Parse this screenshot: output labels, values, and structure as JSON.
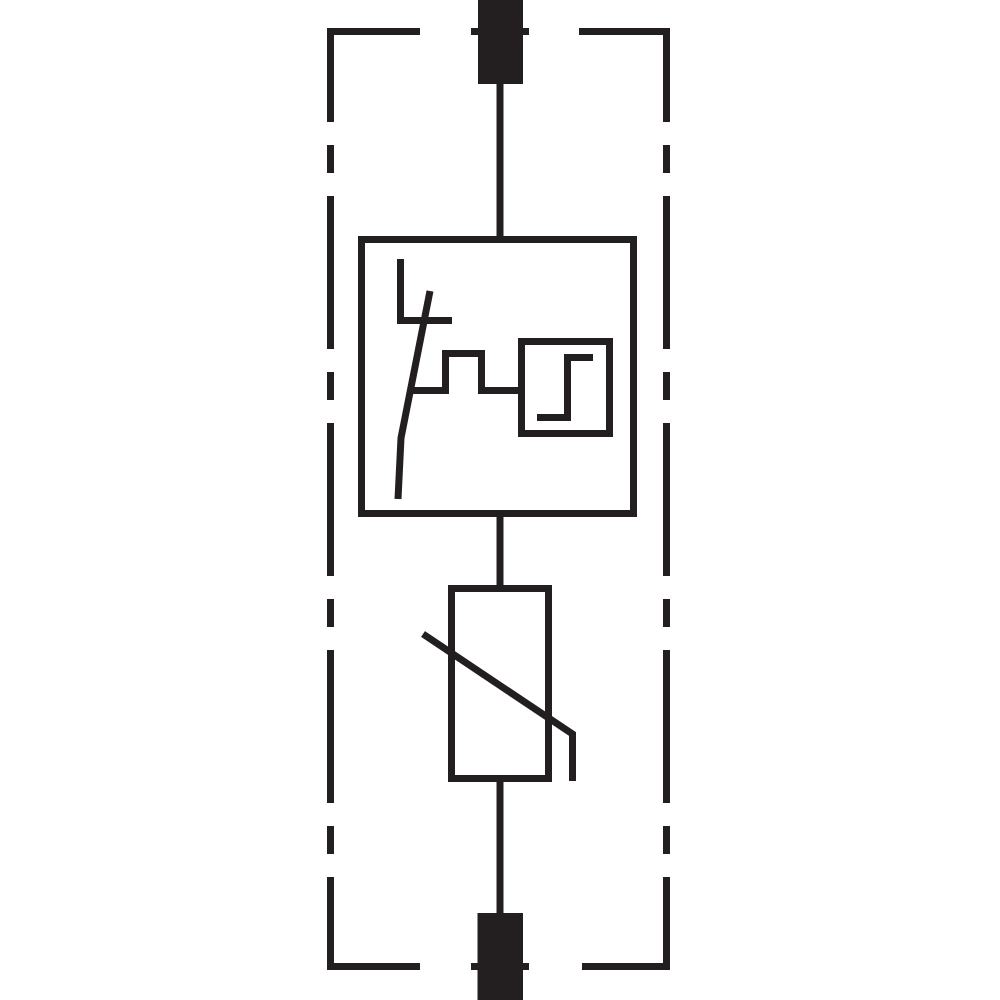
{
  "page": {
    "background_color": "#ffffff"
  },
  "diagram": {
    "kind": "surge-arrester-circuit-symbol",
    "stroke_width_px": 7,
    "colors": {
      "line": "#231f20",
      "background": "#ffffff"
    },
    "components": [
      {
        "name": "top-terminal-pin"
      },
      {
        "name": "dashed-enclosure-boundary"
      },
      {
        "name": "thermal-disconnector-symbol"
      },
      {
        "name": "trip-indicator-step-signal"
      },
      {
        "name": "varistor-symbol"
      },
      {
        "name": "bottom-terminal-pin"
      },
      {
        "name": "connection-wires"
      }
    ]
  }
}
